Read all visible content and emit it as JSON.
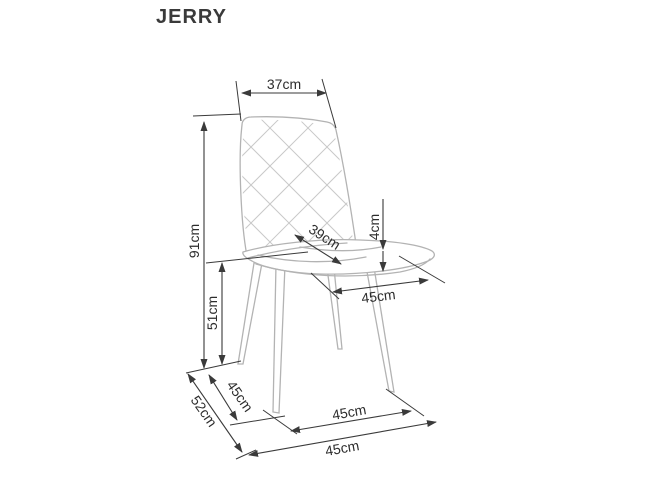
{
  "title": "JERRY",
  "diagram": {
    "type": "furniture-dimension-drawing",
    "subject": "upholstered dining chair with quilted backrest and four tapered legs",
    "dimensions": [
      {
        "name": "backrest-width",
        "label": "37cm"
      },
      {
        "name": "overall-height",
        "label": "91cm"
      },
      {
        "name": "seat-height",
        "label": "51cm"
      },
      {
        "name": "seat-depth",
        "label": "39cm"
      },
      {
        "name": "seat-cushion-thickness",
        "label": "4cm"
      },
      {
        "name": "seat-width",
        "label": "45cm"
      },
      {
        "name": "base-depth-outer",
        "label": "52cm"
      },
      {
        "name": "base-depth-inner",
        "label": "45cm"
      },
      {
        "name": "base-width-inner",
        "label": "45cm"
      },
      {
        "name": "base-width-outer",
        "label": "45cm"
      }
    ],
    "colors": {
      "background": "#ffffff",
      "dimension_lines": "#3a3a3a",
      "dimension_text": "#2d2d2d",
      "chair_outline": "#b3b3b3",
      "quilt_lines": "#c9c9c9",
      "title_text": "#3a3a3a"
    }
  }
}
